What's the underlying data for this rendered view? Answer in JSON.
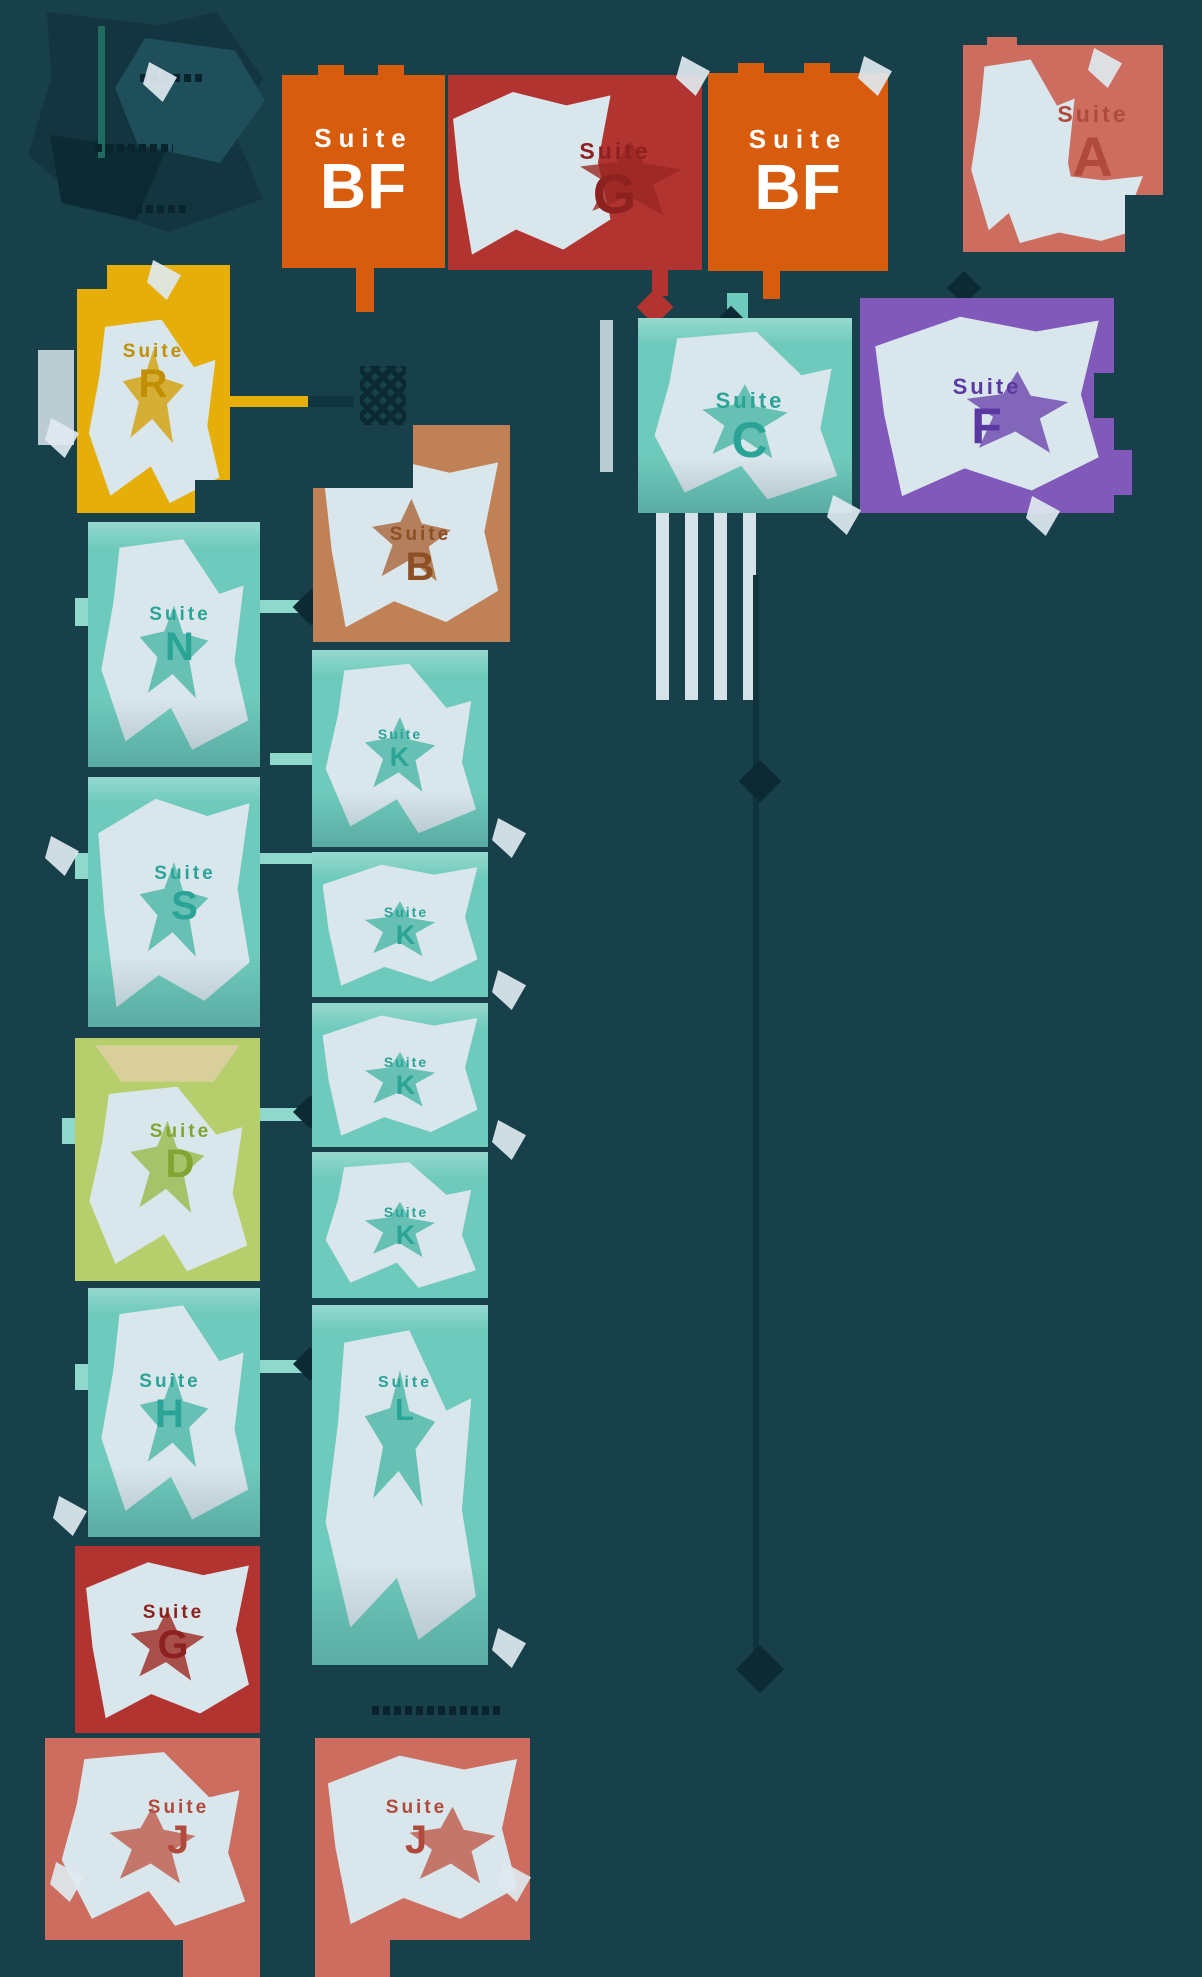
{
  "map": {
    "kind": "building-floor-plan",
    "background": "#17404b"
  },
  "palette": {
    "background": "#17404b",
    "corridor_ink": "#0c2a33",
    "orange": "#d85c0e",
    "dark_red": "#b13430",
    "salmon": "#cd6d5f",
    "teal": "#6ecabc",
    "purple": "#8159ba",
    "yellow": "#e6ae08",
    "green": "#b6cf6c",
    "brown": "#c18156",
    "pale_floor": "#d9e6ec",
    "connector": "#8fd8cc",
    "white": "#ffffff"
  },
  "suites": [
    {
      "name": "suite-bf-northwest",
      "label": "Suite",
      "letter": "BF",
      "color": "#d85c0e"
    },
    {
      "name": "suite-g-north",
      "label": "Suite",
      "letter": "G",
      "color": "#b13430"
    },
    {
      "name": "suite-bf-north",
      "label": "Suite",
      "letter": "BF",
      "color": "#d85c0e"
    },
    {
      "name": "suite-a-northeast",
      "label": "Suite",
      "letter": "A",
      "color": "#cd6d5f"
    },
    {
      "name": "suite-c-central",
      "label": "Suite",
      "letter": "C",
      "color": "#6ecabc"
    },
    {
      "name": "suite-f-east",
      "label": "Suite",
      "letter": "F",
      "color": "#8159ba"
    },
    {
      "name": "suite-r-west",
      "label": "Suite",
      "letter": "R",
      "color": "#e6ae08"
    },
    {
      "name": "suite-b-central",
      "label": "Suite",
      "letter": "B",
      "color": "#c18156"
    },
    {
      "name": "suite-n-west",
      "label": "Suite",
      "letter": "N",
      "color": "#6ecabc"
    },
    {
      "name": "suite-s-west",
      "label": "Suite",
      "letter": "S",
      "color": "#6ecabc"
    },
    {
      "name": "suite-d-west",
      "label": "Suite",
      "letter": "D",
      "color": "#b6cf6c"
    },
    {
      "name": "suite-h-west",
      "label": "Suite",
      "letter": "H",
      "color": "#6ecabc"
    },
    {
      "name": "suite-g-southwest",
      "label": "Suite",
      "letter": "G",
      "color": "#b13430"
    },
    {
      "name": "suite-j-south-left",
      "label": "Suite",
      "letter": "J",
      "color": "#cd6d5f"
    },
    {
      "name": "suite-j-south-right",
      "label": "Suite",
      "letter": "J",
      "color": "#cd6d5f"
    },
    {
      "name": "suite-k-mid-1",
      "label": "Suite",
      "letter": "K",
      "color": "#6ecabc"
    },
    {
      "name": "suite-k-mid-2",
      "label": "Suite",
      "letter": "K",
      "color": "#6ecabc"
    },
    {
      "name": "suite-k-mid-3",
      "label": "Suite",
      "letter": "K",
      "color": "#6ecabc"
    },
    {
      "name": "suite-k-mid-4",
      "label": "Suite",
      "letter": "K",
      "color": "#6ecabc"
    },
    {
      "name": "suite-l-mid-south",
      "label": "Suite",
      "letter": "L",
      "color": "#6ecabc"
    }
  ],
  "icons": {
    "stairs": "stairs-icon",
    "staircase": "staircase-stripes",
    "door_swing": "door-arc-icon",
    "connector_arrow": "connector-arrow-icon"
  }
}
